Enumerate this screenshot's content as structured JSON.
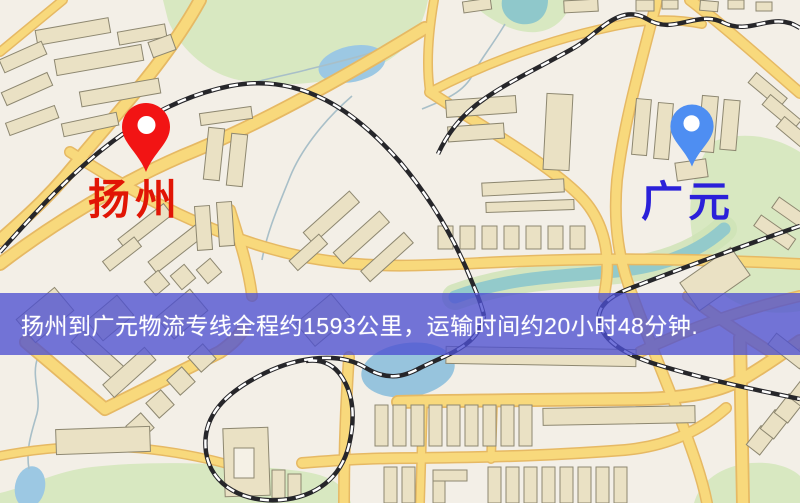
{
  "map": {
    "origin": {
      "label": "扬州",
      "pin_color": "#f21414"
    },
    "destination": {
      "label": "广元",
      "pin_color": "#4e8ef2"
    }
  },
  "banner": {
    "text": "扬州到广元物流专线全程约1593公里，运输时间约20小时48分钟.",
    "route": "扬州到广元物流专线",
    "distance": "1593公里",
    "duration": "20小时48分钟",
    "background_color": "#4d4fd1",
    "text_color": "#ffffff"
  }
}
